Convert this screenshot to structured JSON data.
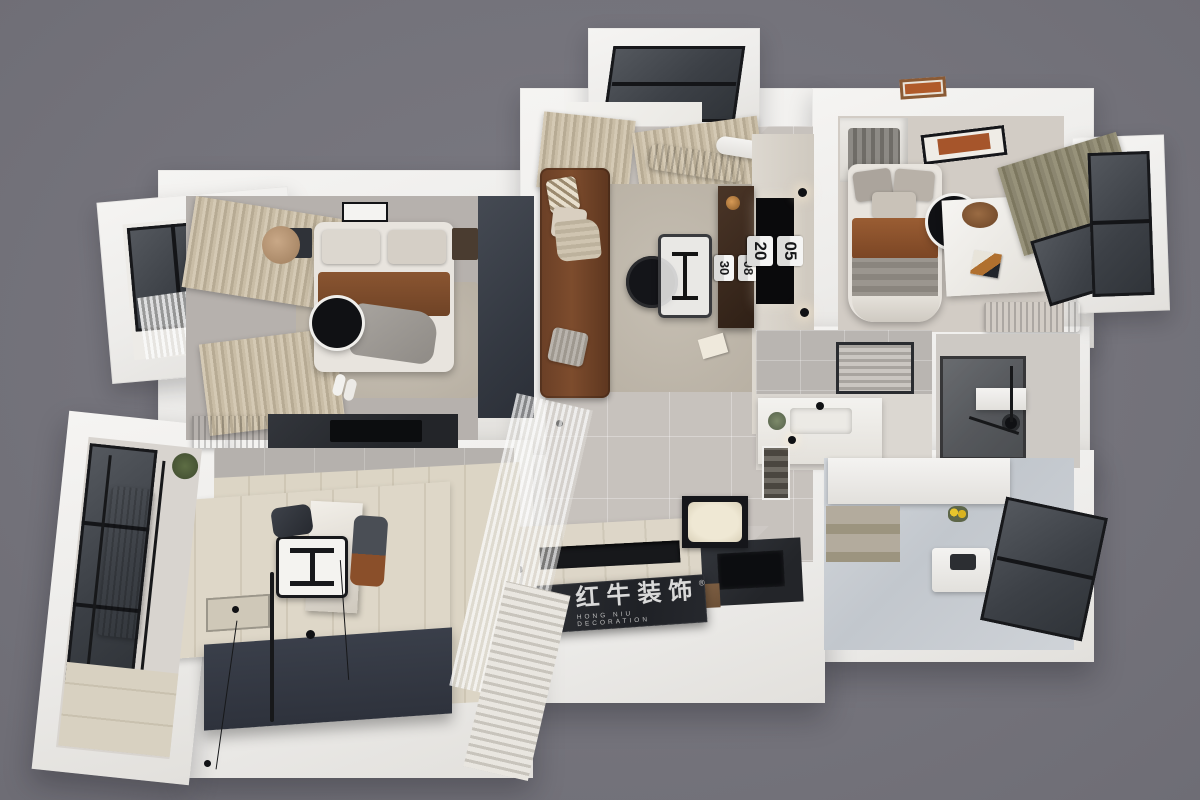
{
  "scene": {
    "description": "3D top-down dollhouse render of a two-bedroom apartment interior",
    "background_color": "#76757d",
    "wall_color": "#f2f1ef",
    "palette": {
      "living_floor": "#c7c2bd",
      "bedroom_floor": "#b6b1ad",
      "wood_floor": "#d8d1c1",
      "platform_navy": "#343942",
      "sofa_brown": "#7d4c2d",
      "blanket_brown": "#8a5531",
      "curtain_beige": "#cfc3ad",
      "curtain_olive": "#8b8670",
      "glass_dark": "#3c4046",
      "logo_plate": "#26282d"
    }
  },
  "watermark": {
    "brand": "红牛装饰",
    "subtitle": "HONG NIU DECORATION",
    "registered_mark": "®"
  },
  "living_room": {
    "tv_clock": {
      "hours": "05",
      "minutes": "20"
    },
    "console_clock": {
      "hours": "08",
      "minutes": "30"
    }
  }
}
